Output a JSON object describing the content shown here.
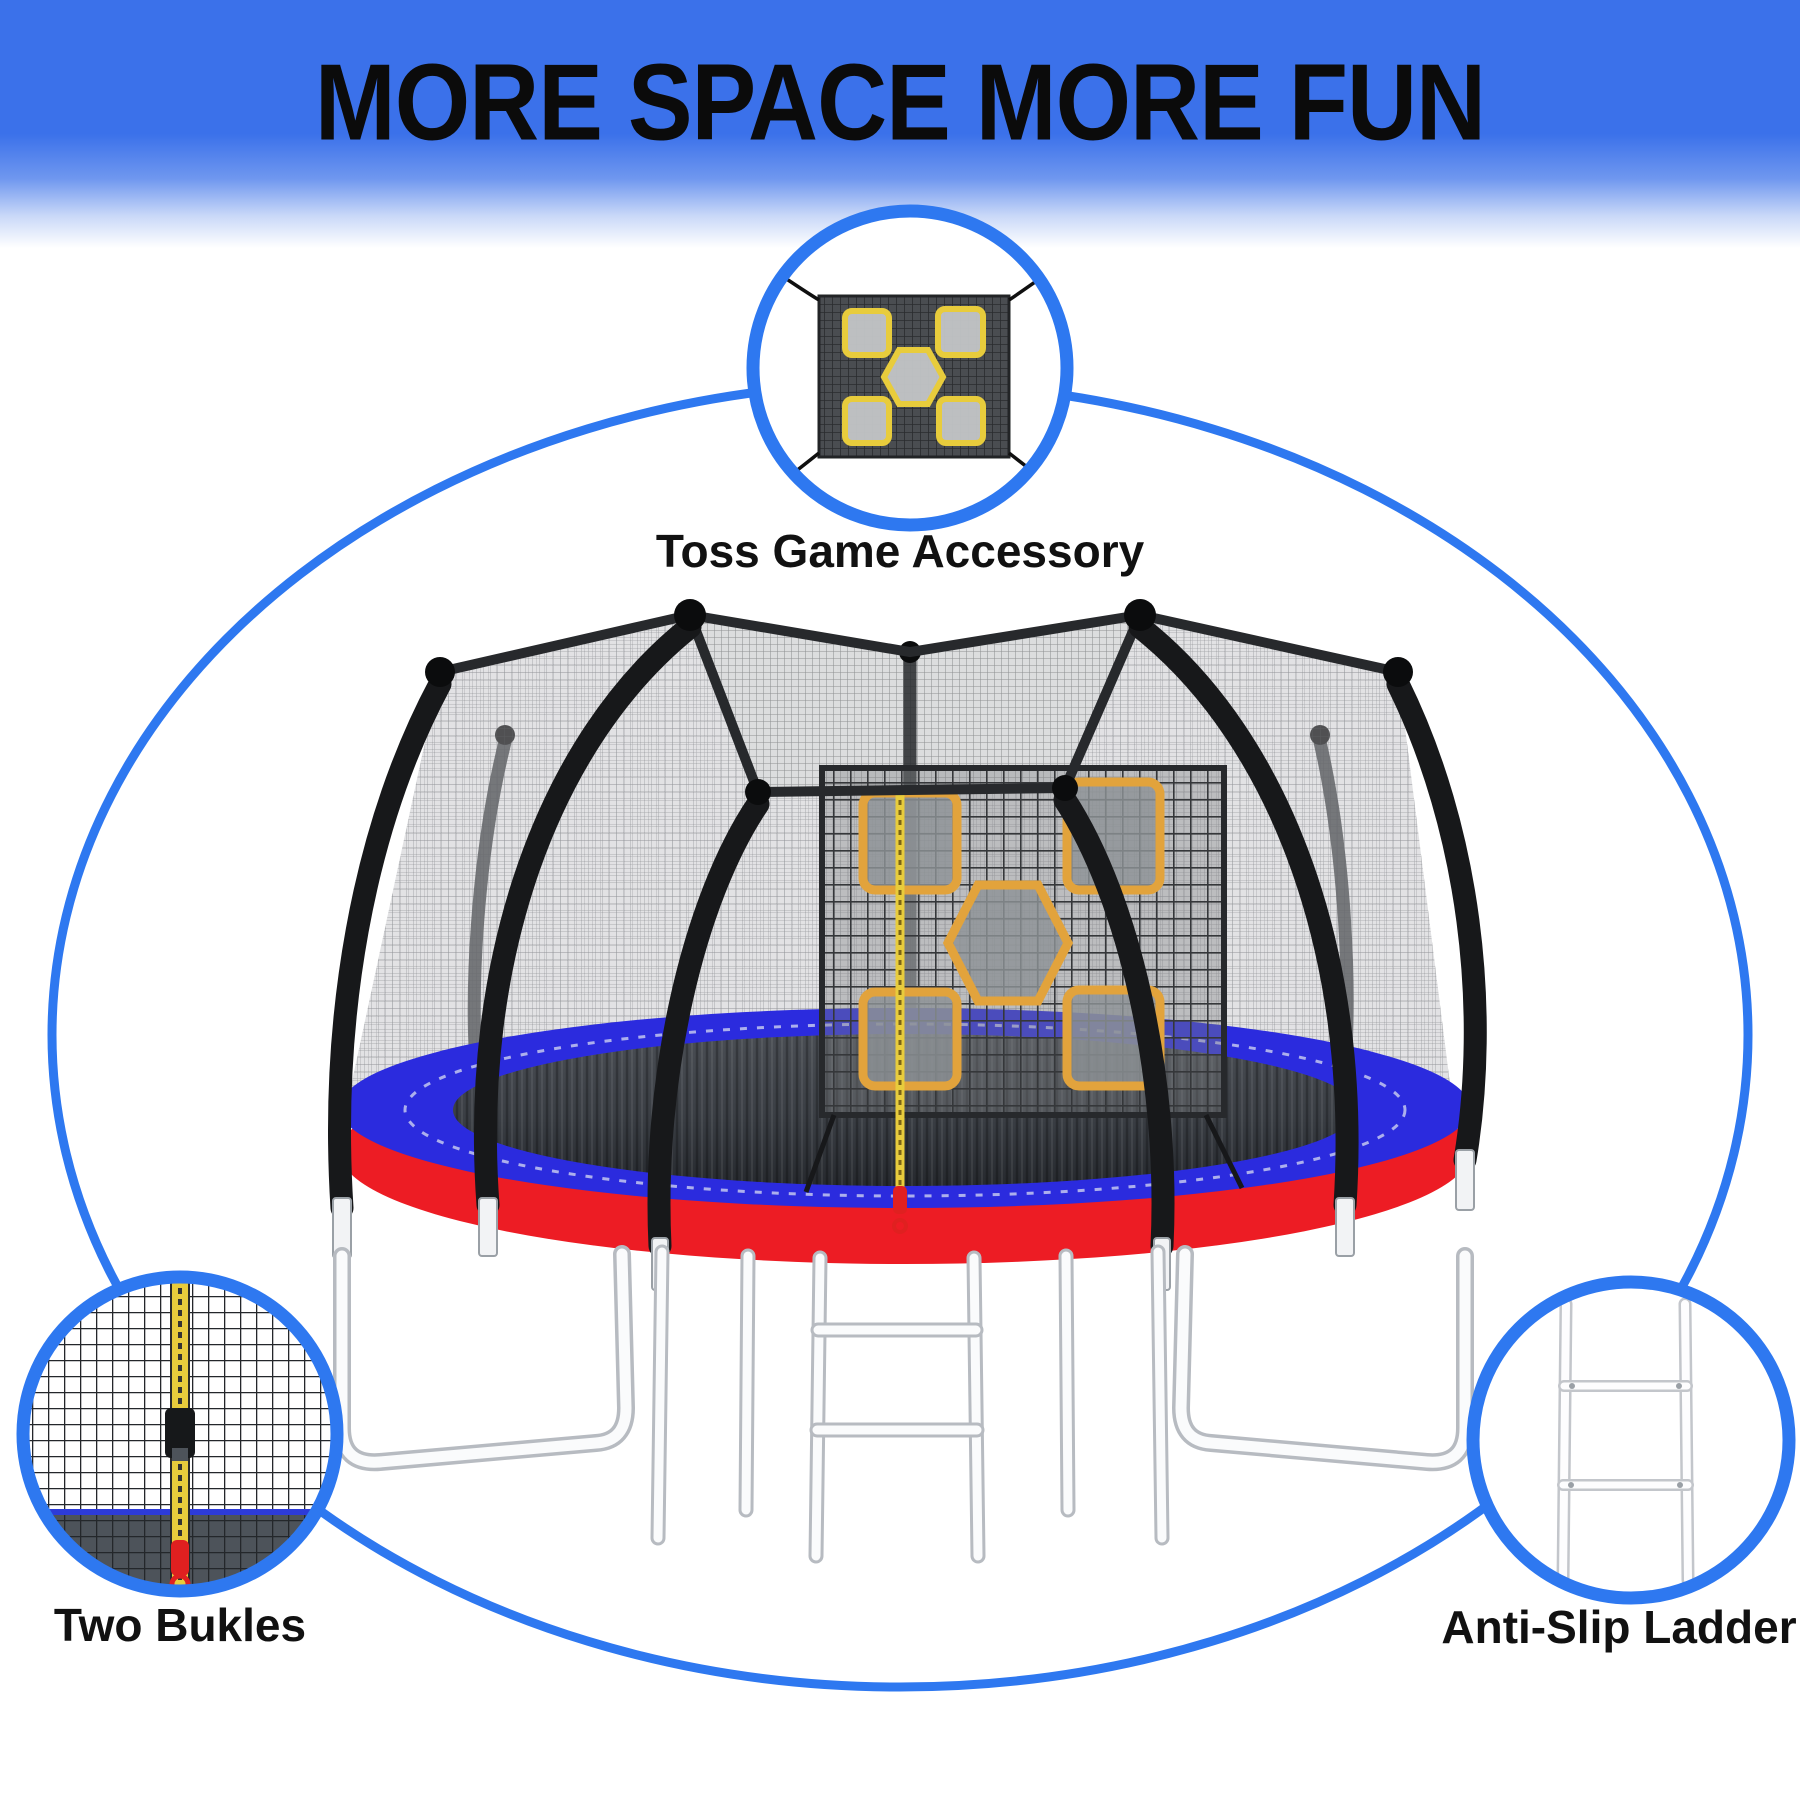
{
  "title": "MORE SPACE MORE FUN",
  "callouts": {
    "toss_game": {
      "label": "Toss Game Accessory",
      "icon": "toss-game-net-icon"
    },
    "buckles": {
      "label": "Two Bukles",
      "icon": "zipper-buckle-icon"
    },
    "ladder": {
      "label": "Anti-Slip Ladder",
      "icon": "ladder-icon"
    }
  },
  "colors": {
    "banner_blue": "#3B71EA",
    "outline_blue": "#2E78F0",
    "pad_blue": "#2B2BDE",
    "pad_red": "#ED1C24",
    "target_orange": "#E2A33C",
    "zipper_yellow": "#E8CC3C",
    "pull_red": "#E02020",
    "title_color": "#0B0B0B"
  }
}
